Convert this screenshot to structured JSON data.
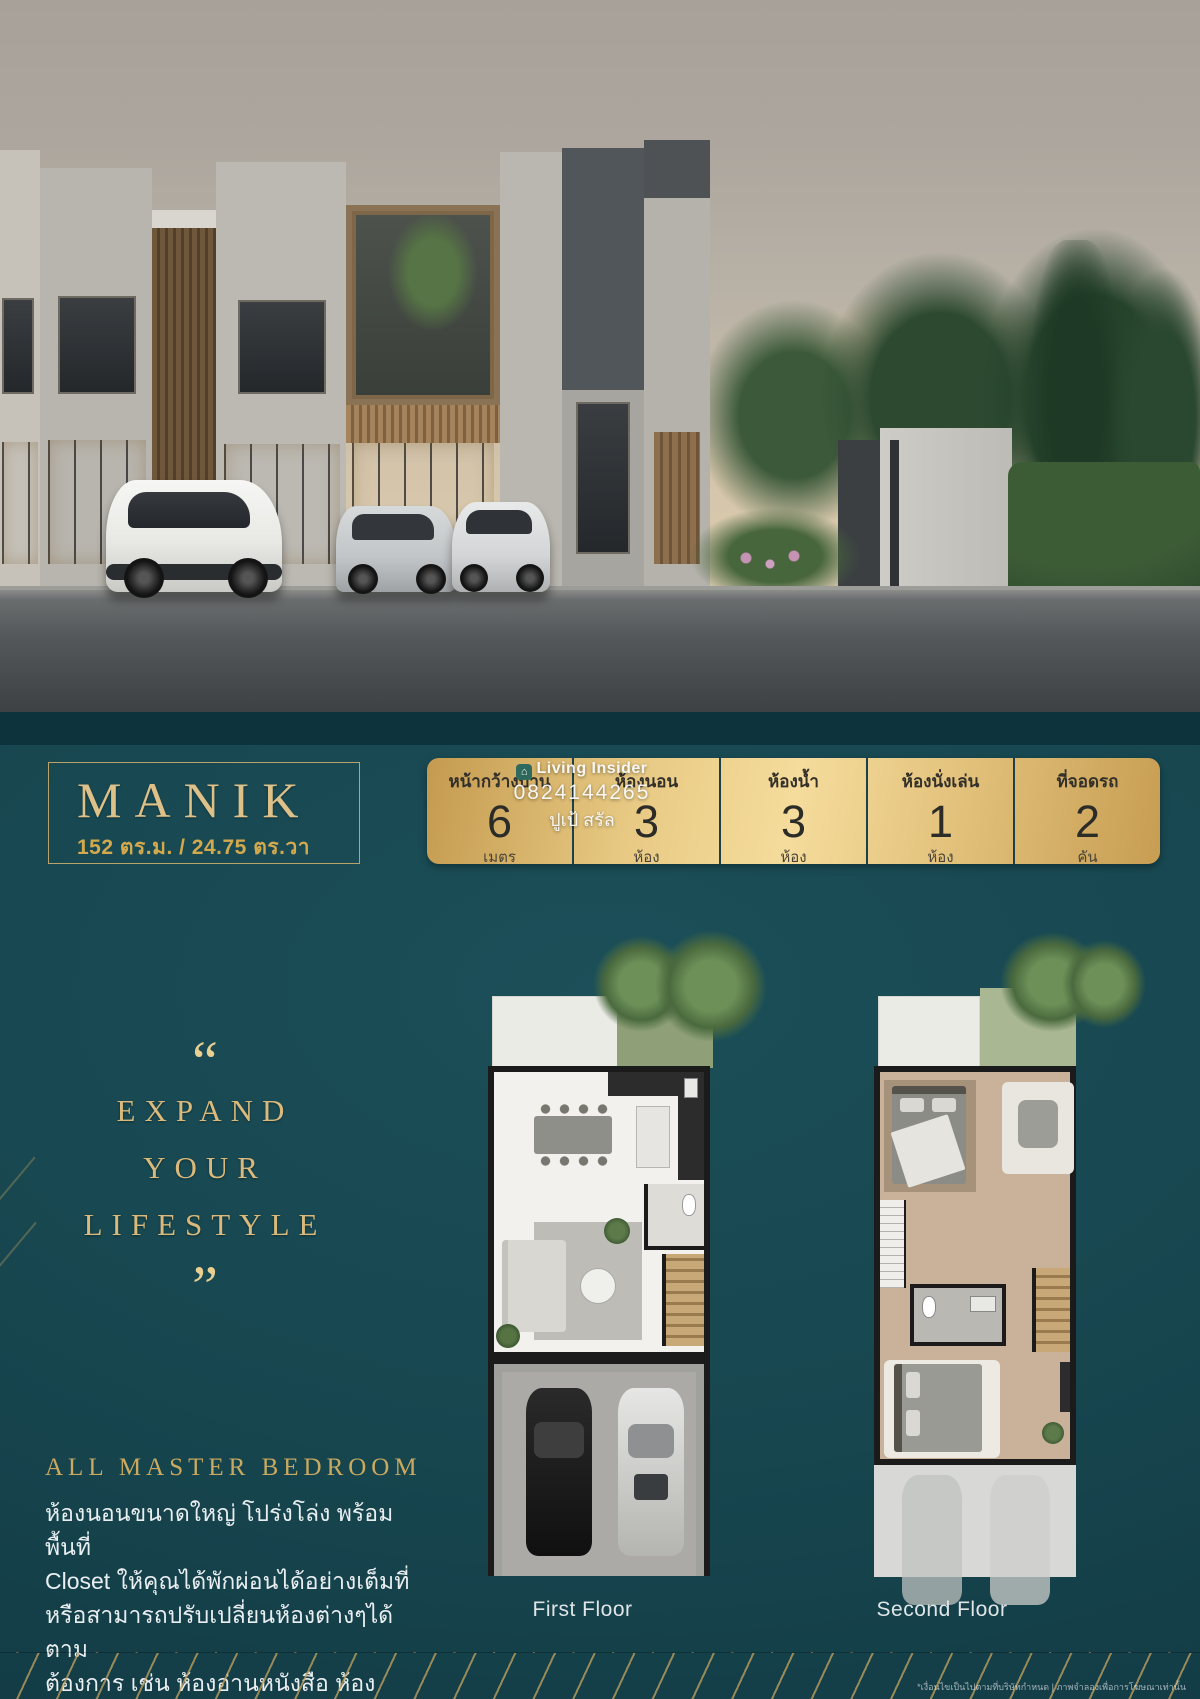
{
  "title_box": {
    "name": "MANIK",
    "size": "152 ตร.ม. / 24.75 ตร.วา"
  },
  "specs": [
    {
      "label": "หน้ากว้างบ้าน",
      "value": "6",
      "unit": "เมตร"
    },
    {
      "label": "ห้องนอน",
      "value": "3",
      "unit": "ห้อง"
    },
    {
      "label": "ห้องน้ำ",
      "value": "3",
      "unit": "ห้อง"
    },
    {
      "label": "ห้องนั่งเล่น",
      "value": "1",
      "unit": "ห้อง"
    },
    {
      "label": "ที่จอดรถ",
      "value": "2",
      "unit": "คัน"
    }
  ],
  "watermark": {
    "brand": "Living Insider",
    "phone": "0824144265",
    "agent": "ปูเป้ สรัล"
  },
  "quote": {
    "open": "“",
    "lines": [
      "EXPAND",
      "YOUR",
      "LIFESTYLE"
    ],
    "close": "”"
  },
  "feature": {
    "heading": "ALL MASTER BEDROOM",
    "body_lines": [
      "ห้องนอนขนาดใหญ่ โปร่งโล่ง พร้อมพื้นที่",
      "Closet ให้คุณได้พักผ่อนได้อย่างเต็มที่",
      "หรือสามารถปรับเปลี่ยนห้องต่างๆได้ตาม",
      "ต้องการ เช่น ห้องอ่านหนังสือ ห้องทำงาน",
      "ห้องนั่งเล่น ห้องสำหรับงานอดิเรก"
    ]
  },
  "floorplans": [
    {
      "label": "First Floor"
    },
    {
      "label": "Second Floor"
    }
  ],
  "footer": {
    "disclaimer": "*เงื่อนไขเป็นไปตามที่บริษัทกำหนด | ภาพจำลองเพื่อการโฆษณาเท่านั้น"
  },
  "colors": {
    "teal_background": "#17464f",
    "gold_accent": "#d9b977",
    "gold_bar": "#e9cb86",
    "text_light": "#e9eef0"
  }
}
